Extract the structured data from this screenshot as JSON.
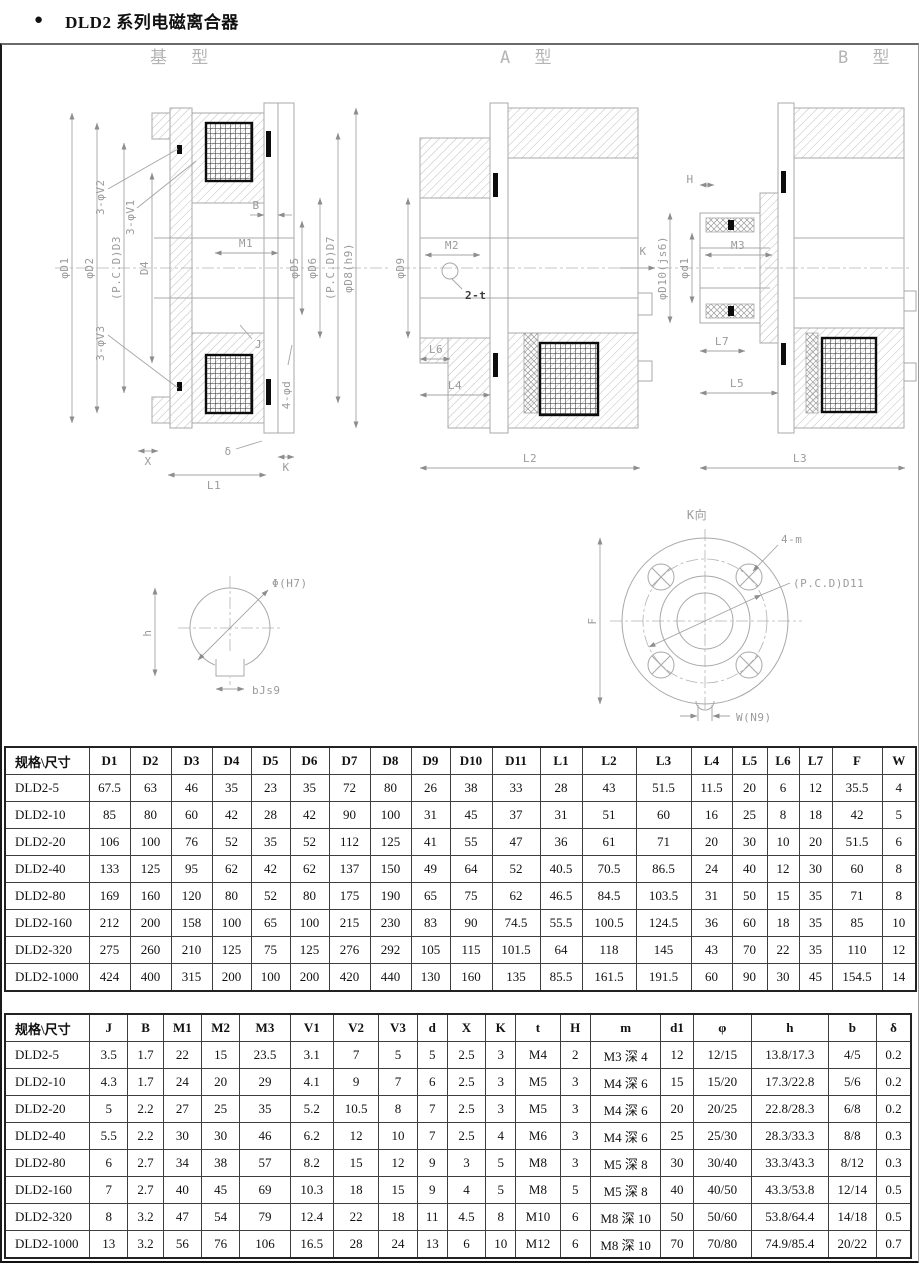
{
  "page": {
    "bullet": "●",
    "title": "DLD2 系列电磁离合器"
  },
  "drawings": {
    "base": {
      "title": "基 型",
      "dims": {
        "d1": "φD1",
        "d2": "φD2",
        "d3": "(P.C.D)D3",
        "d4": "D4",
        "v2": "3-φV2",
        "v1": "3-φV1",
        "v3": "3-φV3",
        "b": "B",
        "m1": "M1",
        "j": "J",
        "d5": "φD5",
        "d6": "φD6",
        "d7": "(P.C.D)D7",
        "d8": "φD8(h9)",
        "fd": "4-φd",
        "x": "X",
        "delta": "δ",
        "k": "K",
        "l1": "L1"
      }
    },
    "typeA": {
      "title": "A 型",
      "dims": {
        "d9": "φD9",
        "m2": "M2",
        "t2": "2-t",
        "k": "K",
        "l6": "L6",
        "l4": "L4",
        "l2": "L2"
      }
    },
    "typeB": {
      "title": "B 型",
      "dims": {
        "h": "H",
        "d10": "φD10(js6)",
        "d1": "φd1",
        "m3": "M3",
        "l7": "L7",
        "l5": "L5",
        "l3": "L3"
      }
    },
    "shaft": {
      "dims": {
        "phi": "Φ(H7)",
        "h": "h",
        "b": "bJs9"
      }
    },
    "flange": {
      "title": "K向",
      "dims": {
        "m": "4-m",
        "d11": "(P.C.D)D11",
        "f": "F",
        "w": "W(N9)"
      }
    }
  },
  "table1": {
    "headers": [
      "规格\\尺寸",
      "D1",
      "D2",
      "D3",
      "D4",
      "D5",
      "D6",
      "D7",
      "D8",
      "D9",
      "D10",
      "D11",
      "L1",
      "L2",
      "L3",
      "L4",
      "L5",
      "L6",
      "L7",
      "F",
      "W"
    ],
    "rows": [
      [
        "DLD2-5",
        "67.5",
        "63",
        "46",
        "35",
        "23",
        "35",
        "72",
        "80",
        "26",
        "38",
        "33",
        "28",
        "43",
        "51.5",
        "11.5",
        "20",
        "6",
        "12",
        "35.5",
        "4"
      ],
      [
        "DLD2-10",
        "85",
        "80",
        "60",
        "42",
        "28",
        "42",
        "90",
        "100",
        "31",
        "45",
        "37",
        "31",
        "51",
        "60",
        "16",
        "25",
        "8",
        "18",
        "42",
        "5"
      ],
      [
        "DLD2-20",
        "106",
        "100",
        "76",
        "52",
        "35",
        "52",
        "112",
        "125",
        "41",
        "55",
        "47",
        "36",
        "61",
        "71",
        "20",
        "30",
        "10",
        "20",
        "51.5",
        "6"
      ],
      [
        "DLD2-40",
        "133",
        "125",
        "95",
        "62",
        "42",
        "62",
        "137",
        "150",
        "49",
        "64",
        "52",
        "40.5",
        "70.5",
        "86.5",
        "24",
        "40",
        "12",
        "30",
        "60",
        "8"
      ],
      [
        "DLD2-80",
        "169",
        "160",
        "120",
        "80",
        "52",
        "80",
        "175",
        "190",
        "65",
        "75",
        "62",
        "46.5",
        "84.5",
        "103.5",
        "31",
        "50",
        "15",
        "35",
        "71",
        "8"
      ],
      [
        "DLD2-160",
        "212",
        "200",
        "158",
        "100",
        "65",
        "100",
        "215",
        "230",
        "83",
        "90",
        "74.5",
        "55.5",
        "100.5",
        "124.5",
        "36",
        "60",
        "18",
        "35",
        "85",
        "10"
      ],
      [
        "DLD2-320",
        "275",
        "260",
        "210",
        "125",
        "75",
        "125",
        "276",
        "292",
        "105",
        "115",
        "101.5",
        "64",
        "118",
        "145",
        "43",
        "70",
        "22",
        "35",
        "110",
        "12"
      ],
      [
        "DLD2-1000",
        "424",
        "400",
        "315",
        "200",
        "100",
        "200",
        "420",
        "440",
        "130",
        "160",
        "135",
        "85.5",
        "161.5",
        "191.5",
        "60",
        "90",
        "30",
        "45",
        "154.5",
        "14"
      ]
    ]
  },
  "table2": {
    "headers": [
      "规格\\尺寸",
      "J",
      "B",
      "M1",
      "M2",
      "M3",
      "V1",
      "V2",
      "V3",
      "d",
      "X",
      "K",
      "t",
      "H",
      "m",
      "d1",
      "φ",
      "h",
      "b",
      "δ"
    ],
    "rows": [
      [
        "DLD2-5",
        "3.5",
        "1.7",
        "22",
        "15",
        "23.5",
        "3.1",
        "7",
        "5",
        "5",
        "2.5",
        "3",
        "M4",
        "2",
        "M3 深 4",
        "12",
        "12/15",
        "13.8/17.3",
        "4/5",
        "0.2"
      ],
      [
        "DLD2-10",
        "4.3",
        "1.7",
        "24",
        "20",
        "29",
        "4.1",
        "9",
        "7",
        "6",
        "2.5",
        "3",
        "M5",
        "3",
        "M4 深 6",
        "15",
        "15/20",
        "17.3/22.8",
        "5/6",
        "0.2"
      ],
      [
        "DLD2-20",
        "5",
        "2.2",
        "27",
        "25",
        "35",
        "5.2",
        "10.5",
        "8",
        "7",
        "2.5",
        "3",
        "M5",
        "3",
        "M4 深 6",
        "20",
        "20/25",
        "22.8/28.3",
        "6/8",
        "0.2"
      ],
      [
        "DLD2-40",
        "5.5",
        "2.2",
        "30",
        "30",
        "46",
        "6.2",
        "12",
        "10",
        "7",
        "2.5",
        "4",
        "M6",
        "3",
        "M4 深 6",
        "25",
        "25/30",
        "28.3/33.3",
        "8/8",
        "0.3"
      ],
      [
        "DLD2-80",
        "6",
        "2.7",
        "34",
        "38",
        "57",
        "8.2",
        "15",
        "12",
        "9",
        "3",
        "5",
        "M8",
        "3",
        "M5 深 8",
        "30",
        "30/40",
        "33.3/43.3",
        "8/12",
        "0.3"
      ],
      [
        "DLD2-160",
        "7",
        "2.7",
        "40",
        "45",
        "69",
        "10.3",
        "18",
        "15",
        "9",
        "4",
        "5",
        "M8",
        "5",
        "M5 深 8",
        "40",
        "40/50",
        "43.3/53.8",
        "12/14",
        "0.5"
      ],
      [
        "DLD2-320",
        "8",
        "3.2",
        "47",
        "54",
        "79",
        "12.4",
        "22",
        "18",
        "11",
        "4.5",
        "8",
        "M10",
        "6",
        "M8 深 10",
        "50",
        "50/60",
        "53.8/64.4",
        "14/18",
        "0.5"
      ],
      [
        "DLD2-1000",
        "13",
        "3.2",
        "56",
        "76",
        "106",
        "16.5",
        "28",
        "24",
        "13",
        "6",
        "10",
        "M12",
        "6",
        "M8 深 10",
        "70",
        "70/80",
        "74.9/85.4",
        "20/22",
        "0.7"
      ]
    ]
  }
}
